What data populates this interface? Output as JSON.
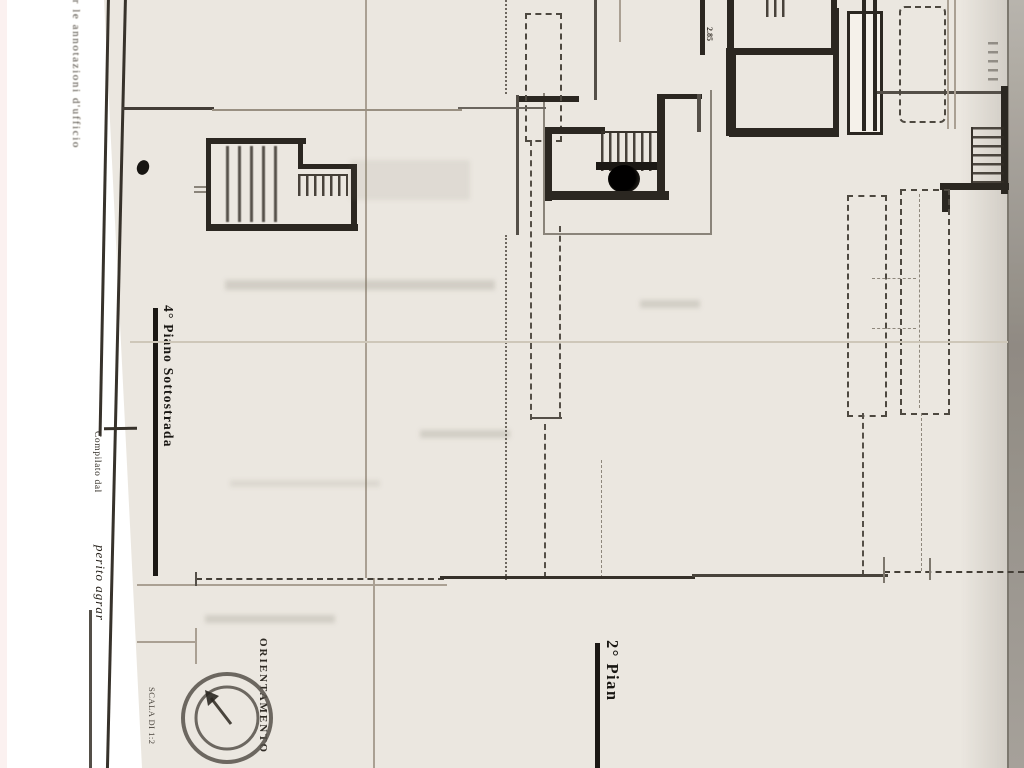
{
  "texts": {
    "margin_note": "per le annotazioni d'ufficio",
    "compiled_by_label": "Compilato dal",
    "compiled_by_value": "perito agrar",
    "floor_label_basement": "4° Piano Sottostrada",
    "floor_label_second": "2° Pian",
    "orientation_label": "ORIENTAMENTO",
    "scale_label": "SCALA DI 1:2",
    "dimension_label": "2.85"
  },
  "colors": {
    "paper": "#ebe7e0",
    "ink": "#2e2a25",
    "faint_line": "#a89f92",
    "edge_gray": "#938e87",
    "margin_white": "#fdfcfa"
  }
}
